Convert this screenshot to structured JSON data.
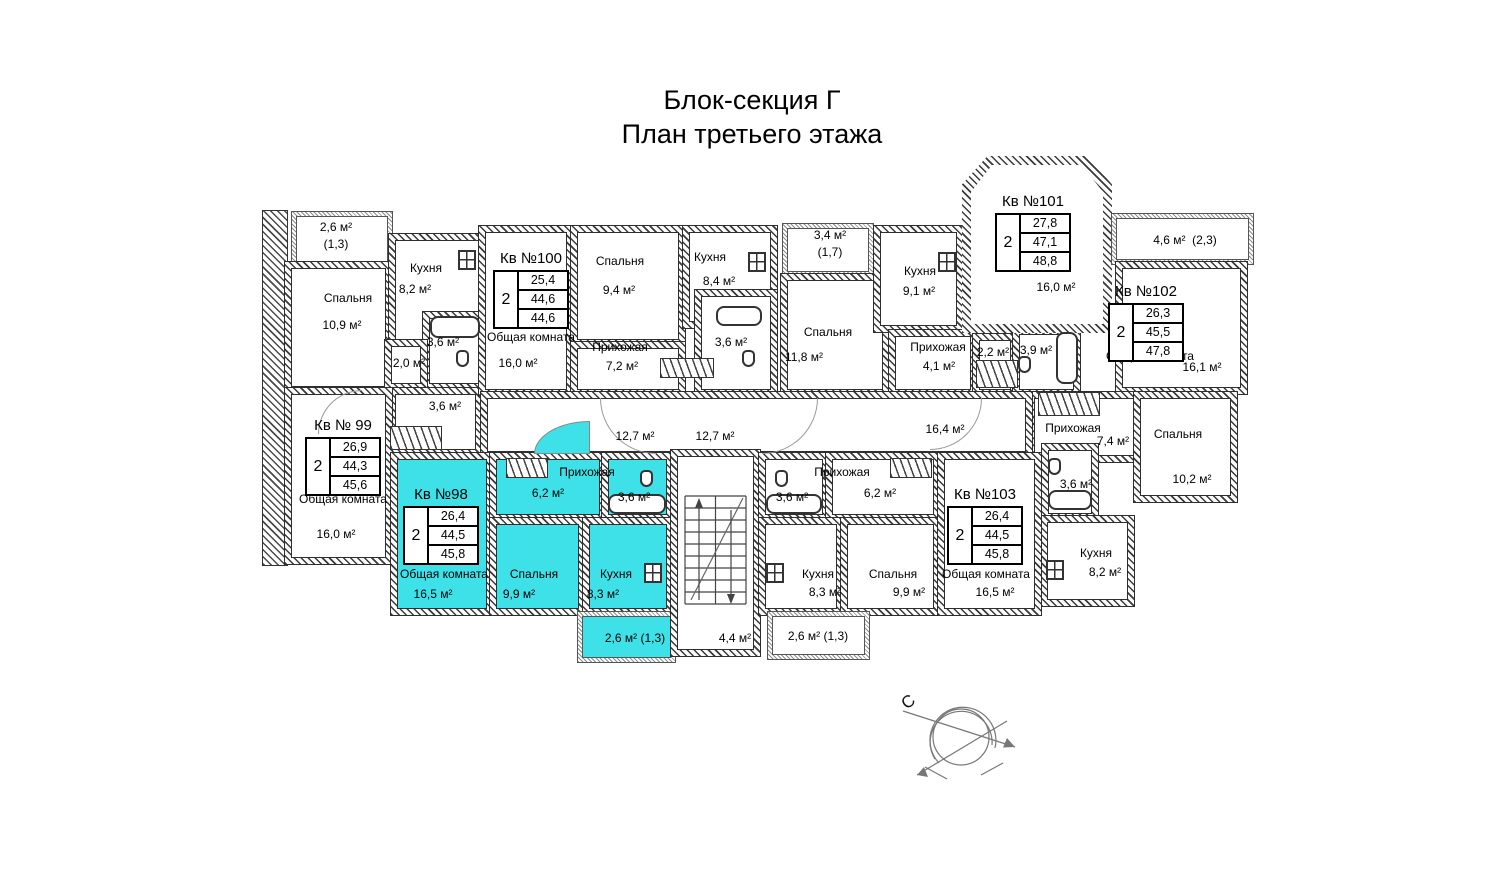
{
  "title": {
    "line1": "Блок-секция Г",
    "line2": "План третьего этажа"
  },
  "apartments": [
    {
      "name": "Кв №98",
      "rooms_count": "2",
      "living_area": "26,4",
      "total_area": "44,5",
      "total_with_balcony": "45,8"
    },
    {
      "name": "Кв № 99",
      "rooms_count": "2",
      "living_area": "26,9",
      "total_area": "44,3",
      "total_with_balcony": "45,6"
    },
    {
      "name": "Кв №100",
      "rooms_count": "2",
      "living_area": "25,4",
      "total_area": "44,6",
      "total_with_balcony": "44,6"
    },
    {
      "name": "Кв №101",
      "rooms_count": "2",
      "living_area": "27,8",
      "total_area": "47,1",
      "total_with_balcony": "48,8"
    },
    {
      "name": "Кв №102",
      "rooms_count": "2",
      "living_area": "26,3",
      "total_area": "45,5",
      "total_with_balcony": "47,8"
    },
    {
      "name": "Кв №103",
      "rooms_count": "2",
      "living_area": "26,4",
      "total_area": "44,5",
      "total_with_balcony": "45,8"
    }
  ],
  "labels": {
    "balc99": {
      "area": "2,6 м²",
      "coef": "(1,3)"
    },
    "bedroom99": {
      "name": "Спальня",
      "area": "10,9 м²"
    },
    "kitchen99": {
      "name": "Кухня",
      "area": "8,2 м²"
    },
    "bath99": {
      "area": "3,6 м²"
    },
    "hall99a": {
      "area": "2,0 м²"
    },
    "hall99b": {
      "area": "3,6 м²"
    },
    "common99": {
      "name": "Общая комната",
      "area": "16,0 м²"
    },
    "common100": {
      "name": "Общая комната",
      "area": "16,0 м²"
    },
    "bedroom100": {
      "name": "Спальня",
      "area": "9,4 м²"
    },
    "hall100": {
      "name": "Прихожая",
      "area": "7,2 м²"
    },
    "kitchen100": {
      "name": "Кухня",
      "area": "8,4 м²"
    },
    "bath100": {
      "area": "3,6 м²"
    },
    "balc_mid": {
      "area": "3,4 м²",
      "coef": "(1,7)"
    },
    "bedroom_mid": {
      "name": "Спальня",
      "area": "11,8 м²"
    },
    "kitchen_mid": {
      "name": "Кухня",
      "area": "9,1 м²"
    },
    "hall_mid": {
      "name": "Прихожая",
      "area": "4,1 м²"
    },
    "closet22": {
      "area": "2,2 м²"
    },
    "bath101": {
      "area": "3,9 м²"
    },
    "room101": {
      "area": "16,0 м²"
    },
    "balc102": {
      "area": "4,6 м²",
      "coef": "(2,3)"
    },
    "common102": {
      "name": "Общая комната",
      "area": "16,1 м²"
    },
    "hall102": {
      "name": "Прихожая",
      "area": "7,4 м²"
    },
    "bedroom102": {
      "name": "Спальня",
      "area": "10,2 м²"
    },
    "bath102": {
      "area": "3,6 м²"
    },
    "kitchen102": {
      "name": "Кухня",
      "area": "8,2 м²"
    },
    "corridor_left": {
      "area": "12,7 м²"
    },
    "corridor_right": {
      "area": "12,7 м²"
    },
    "corridor_main": {
      "area": "16,4 м²"
    },
    "hall98": {
      "name": "Прихожая",
      "area": "6,2 м²"
    },
    "bath98": {
      "area": "3,6 м²"
    },
    "common98": {
      "name": "Общая комната",
      "area": "16,5 м²"
    },
    "bedroom98": {
      "name": "Спальня",
      "area": "9,9 м²"
    },
    "kitchen98": {
      "name": "Кухня",
      "area": "8,3 м²"
    },
    "balc98": {
      "area": "2,6 м²",
      "coef": "(1,3)"
    },
    "stairwell": {
      "area": "4,4 м²"
    },
    "bath103": {
      "area": "3,6 м²"
    },
    "hall103": {
      "name": "Прихожая",
      "area": "6,2 м²"
    },
    "kitchen103": {
      "name": "Кухня",
      "area": "8,3 м²"
    },
    "bedroom103": {
      "name": "Спальня",
      "area": "9,9 м²"
    },
    "common103": {
      "name": "Общая комната",
      "area": "16,5 м²"
    },
    "balc103": {
      "area": "2,6 м²",
      "coef": "(1,3)"
    }
  },
  "compass": {
    "north_label": "С"
  },
  "colors": {
    "highlight": "#3fe1e8"
  }
}
